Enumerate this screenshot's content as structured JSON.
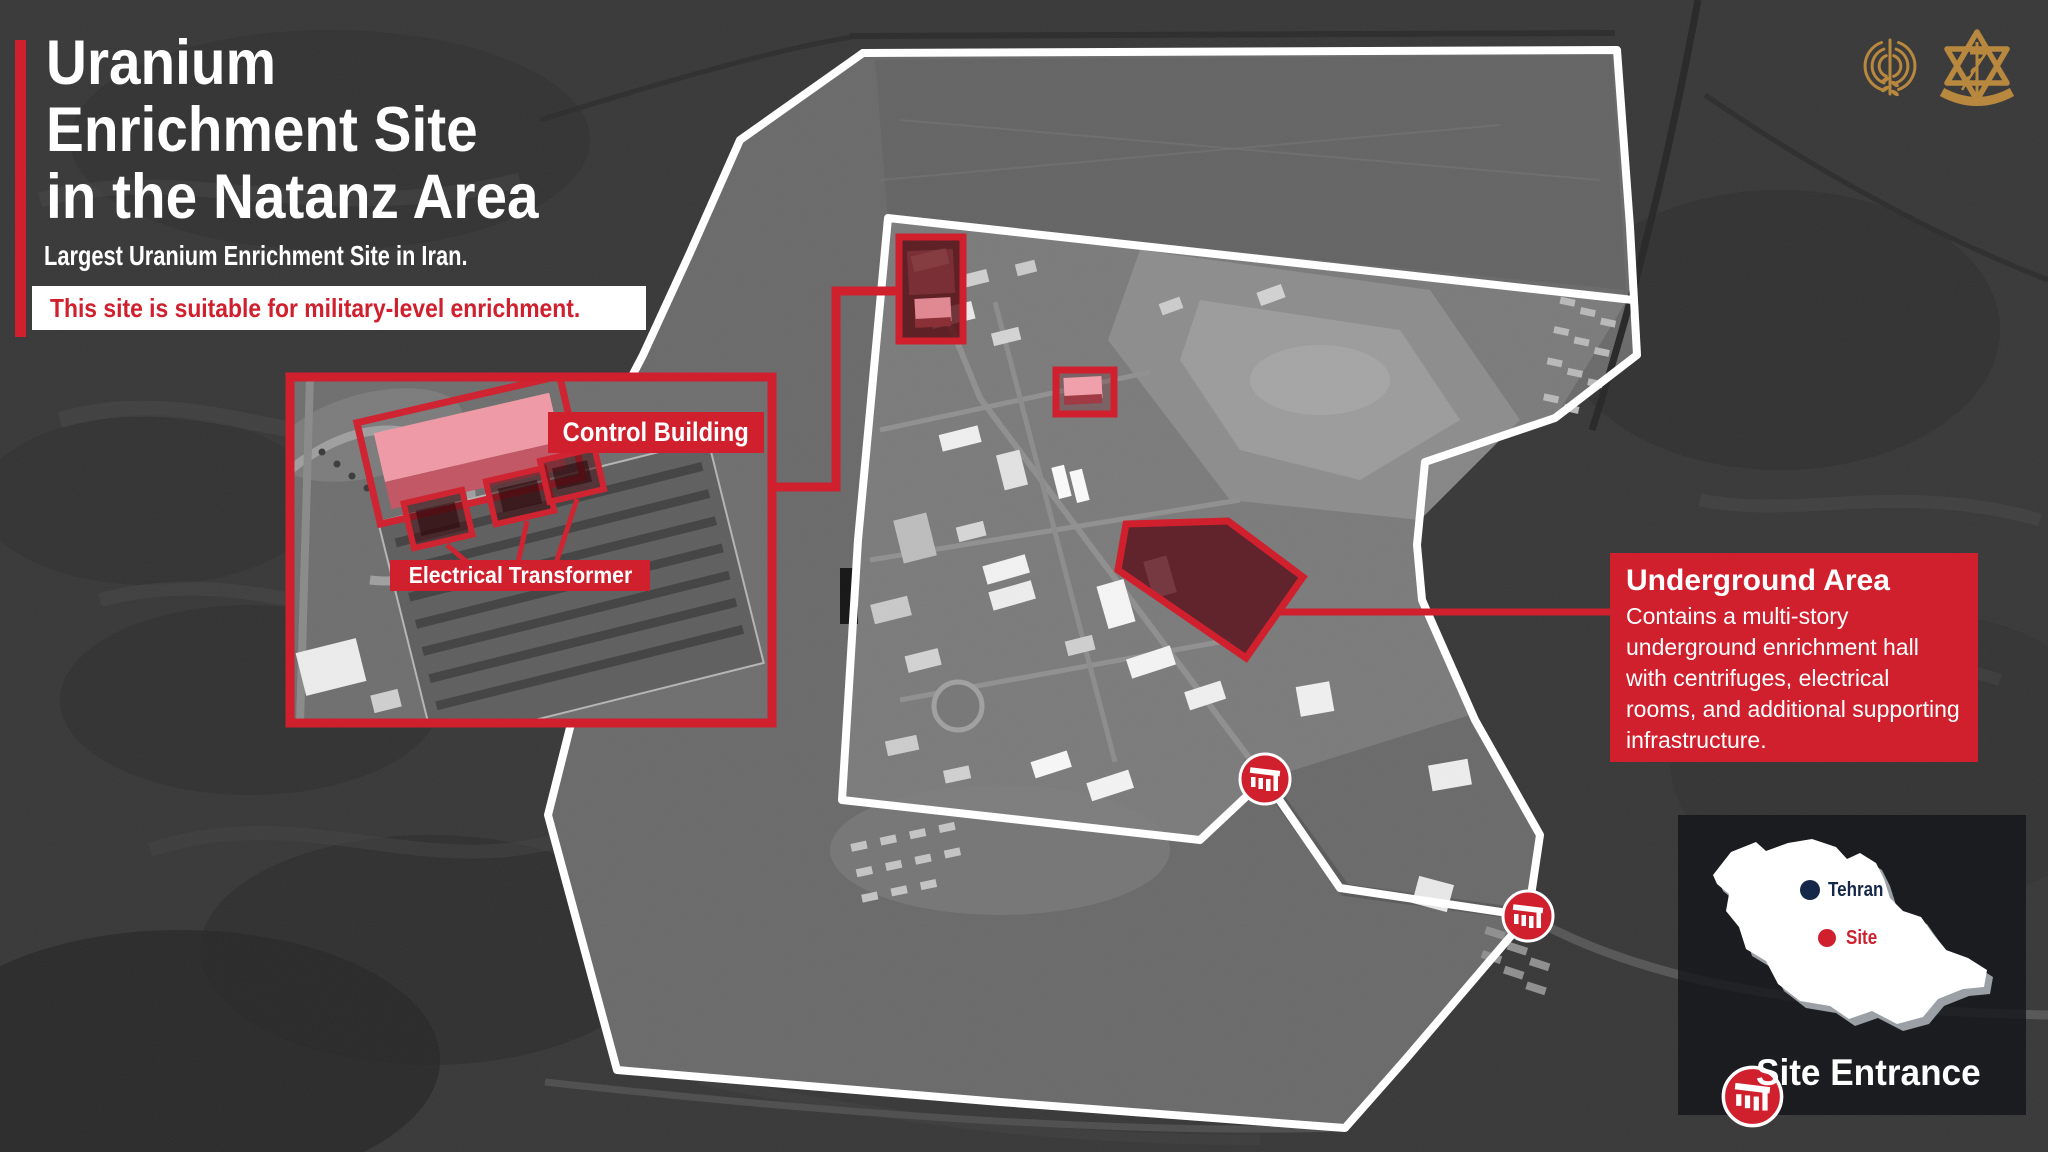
{
  "header": {
    "accent_color": "#d0202e",
    "title_lines": [
      "Uranium",
      "Enrichment Site",
      "in the Natanz Area"
    ],
    "subtitle": "Largest Uranium Enrichment Site in Iran.",
    "banner": "This site is suitable for military-level enrichment."
  },
  "inset": {
    "control_building_label": "Control Building",
    "electrical_transformer_label": "Electrical Transformer"
  },
  "callout": {
    "title": "Underground Area",
    "body": "Contains a multi-story underground enrichment hall with centrifuges, electrical rooms, and additional supporting infrastructure."
  },
  "minimap": {
    "capital_label": "Tehran",
    "site_label": "Site",
    "legend_label": "Site Entrance",
    "capital_dot_color": "#16284a",
    "site_dot_color": "#d0202e"
  },
  "icons": {
    "site_entrance": "factory-gate-icon",
    "logo_left": "intelligence-corps-emblem-icon",
    "logo_right": "idf-emblem-icon"
  },
  "colors": {
    "accent_red": "#d0202e",
    "highlight_fill": "#5a0e16",
    "boundary_white": "#ffffff",
    "emblem_gold": "#b9883f"
  }
}
